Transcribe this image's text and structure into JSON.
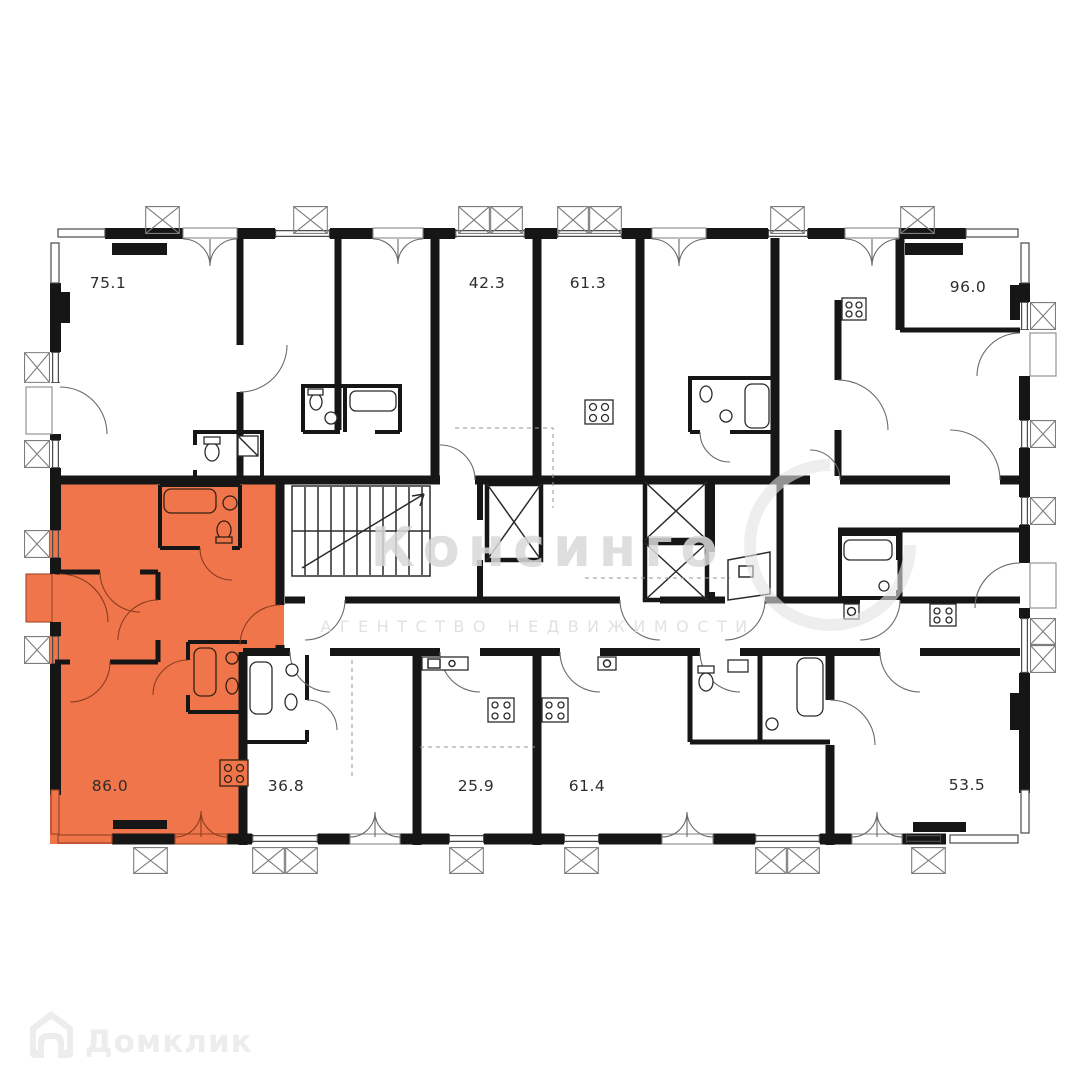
{
  "watermark": {
    "brand": "Консинго",
    "subtitle": "АГЕНТСТВО НЕДВИЖИМОСТИ"
  },
  "branding": {
    "logo_label": "Домклик"
  },
  "plan": {
    "highlight_color": "#f0754a",
    "wall_color": "#161616",
    "units": [
      {
        "id": "unit-75-1",
        "area_label": "75.1",
        "row": "top",
        "highlighted": false
      },
      {
        "id": "unit-42-3",
        "area_label": "42.3",
        "row": "top",
        "highlighted": false
      },
      {
        "id": "unit-61-3",
        "area_label": "61.3",
        "row": "top",
        "highlighted": false
      },
      {
        "id": "unit-96-0",
        "area_label": "96.0",
        "row": "top",
        "highlighted": false
      },
      {
        "id": "unit-86-0",
        "area_label": "86.0",
        "row": "bottom",
        "highlighted": true
      },
      {
        "id": "unit-36-8",
        "area_label": "36.8",
        "row": "bottom",
        "highlighted": false
      },
      {
        "id": "unit-25-9",
        "area_label": "25.9",
        "row": "bottom",
        "highlighted": false
      },
      {
        "id": "unit-61-4",
        "area_label": "61.4",
        "row": "bottom",
        "highlighted": false
      },
      {
        "id": "unit-53-5",
        "area_label": "53.5",
        "row": "bottom",
        "highlighted": false
      }
    ]
  }
}
